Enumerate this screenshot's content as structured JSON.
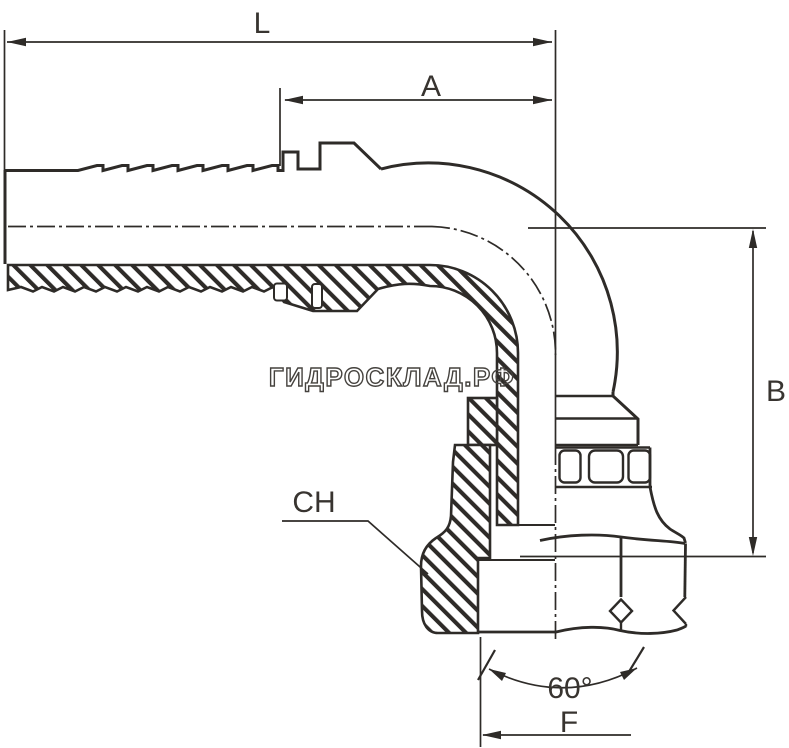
{
  "drawing": {
    "watermark": "ГИДРОСКЛАД.РФ",
    "dimensions": {
      "overall_length": "L",
      "tail_length": "A",
      "height": "B",
      "wrench_size": "CH",
      "thread": "F",
      "seat_angle": "60°"
    },
    "colors": {
      "line": "#2e2b28",
      "watermark": "#45423e",
      "background": "#ffffff"
    }
  }
}
